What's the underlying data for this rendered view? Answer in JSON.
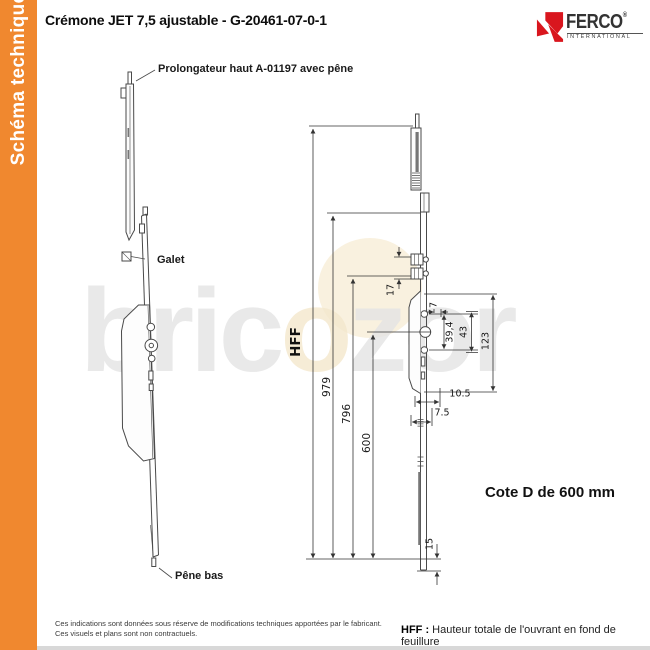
{
  "sidebar": {
    "label": "Schéma technique",
    "accent_color": "#F0882F"
  },
  "header": {
    "title": "Crémone JET 7,5 ajustable - G-20461-07-0-1",
    "logo": {
      "name": "FERCO",
      "registered": "®",
      "subtitle": "INTERNATIONAL",
      "brand_red": "#D9161E"
    }
  },
  "watermark": {
    "part1": "bric",
    "part2": "o",
    "part3": "zor"
  },
  "diagram": {
    "labels": {
      "prolongateur": "Prolongateur haut A-01197 avec pêne",
      "galet": "Galet",
      "pene_bas": "Pêne bas",
      "cote": "Cote D de 600 mm"
    },
    "dimensions": {
      "hff": "HFF",
      "d979": "979",
      "d796": "796",
      "d600": "600",
      "d17": "17",
      "d7": "7",
      "d39_4": "39,4",
      "d43": "43",
      "d123": "123",
      "d10_5": "10.5",
      "d7_5": "7.5",
      "d15": "15"
    }
  },
  "footer": {
    "line1": "Ces indications sont données sous réserve de modifications techniques apportées par le fabricant.",
    "line2": "Ces visuels et plans sont non contractuels.",
    "hff_term": "HFF :",
    "hff_def": "Hauteur totale de l'ouvrant en fond de feuillure"
  }
}
